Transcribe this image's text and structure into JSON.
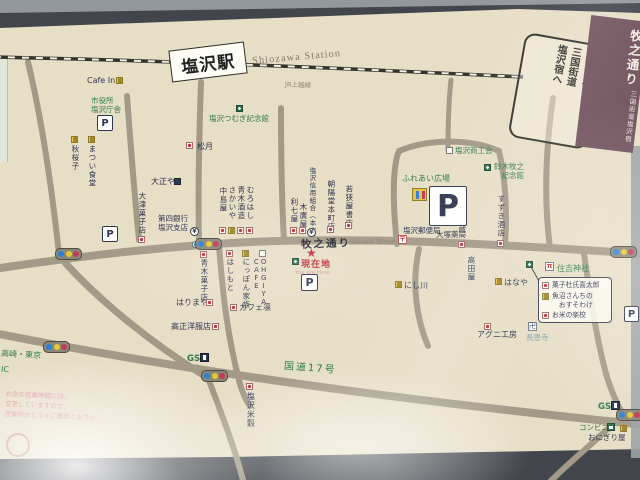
{
  "colors": {
    "board": "#e7dec6",
    "road": "#a29a87",
    "rail": "#33332f",
    "green": "#2e7b4e",
    "navy": "#2e3350",
    "red": "#c2303a",
    "banner": "#70515c",
    "wall": "#42464c",
    "signal_blue": "#2e7fd6",
    "signal_yellow": "#e6c92f",
    "signal_red": "#c23a55"
  },
  "station": {
    "name": "塩沢駅",
    "name_en": "Shiozawa Station",
    "line": "JR上越線"
  },
  "seal": {
    "text": "ようこそ、\n三国街道\n塩沢宿へ"
  },
  "banner": {
    "small": "三国街道塩沢宿",
    "large": "牧之通り"
  },
  "streets": {
    "bokushi": "牧之通り",
    "bokushi_en": "Bokushi Street",
    "route17": "国道17号"
  },
  "current_location": {
    "star": "★",
    "label": "現在地",
    "label_en": "You are Here"
  },
  "icon_glyphs": {
    "yen": "¥",
    "post": "〒",
    "torii": "π",
    "temple": "卍",
    "parking": "P"
  },
  "callout": {
    "items": [
      {
        "icon": "shop",
        "label": "菓子杜氏喜太郎"
      },
      {
        "icon": "food",
        "label": "魚沼さんちの\n　おすそわけ"
      },
      {
        "icon": "shop",
        "label": "お米の楽校"
      }
    ]
  },
  "note": {
    "text": "お店の営業時間には、\n変更していますので、\n営業中かどうかご確認ください"
  },
  "parkings": [
    {
      "x": 97,
      "y": 115,
      "w": 14,
      "h": 14,
      "fs": 10
    },
    {
      "x": 429,
      "y": 186,
      "w": 36,
      "h": 38,
      "fs": 30
    },
    {
      "x": 102,
      "y": 226,
      "w": 14,
      "h": 14,
      "fs": 10
    },
    {
      "x": 301,
      "y": 274,
      "w": 15,
      "h": 15,
      "fs": 11
    },
    {
      "x": 624,
      "y": 306,
      "w": 13,
      "h": 14,
      "fs": 10
    }
  ],
  "signals": [
    {
      "x": 55,
      "y": 248
    },
    {
      "x": 195,
      "y": 238
    },
    {
      "x": 610,
      "y": 246
    },
    {
      "x": 201,
      "y": 370
    },
    {
      "x": 43,
      "y": 341
    },
    {
      "x": 616,
      "y": 409
    }
  ],
  "pois": [
    {
      "id": "cafe-in",
      "label": "Cafe In",
      "x": 87,
      "y": 76,
      "s": 8,
      "roman": 1,
      "icon": "food",
      "ix": 116,
      "iy": 77
    },
    {
      "id": "city-office",
      "label": "市役所\n塩沢庁舎",
      "x": 91,
      "y": 96,
      "s": 7.5,
      "c": "green"
    },
    {
      "id": "matsui-shokudo",
      "label": "まつい食堂",
      "v": 1,
      "x": 88,
      "y": 145,
      "s": 7.5,
      "icon": "food",
      "ix": 88,
      "iy": 136
    },
    {
      "id": "shuoshi",
      "label": "秋桜子",
      "v": 1,
      "x": 71,
      "y": 145,
      "s": 7.5,
      "icon": "food",
      "ix": 71,
      "iy": 136
    },
    {
      "id": "tsumugi-kinenkan",
      "label": "塩沢つむぎ記念館",
      "x": 209,
      "y": 114,
      "s": 7.5,
      "c": "green",
      "icon": "pub",
      "ix": 236,
      "iy": 105
    },
    {
      "id": "shogetsu",
      "label": "松月",
      "x": 197,
      "y": 142,
      "s": 8,
      "icon": "shop",
      "ix": 186,
      "iy": 142
    },
    {
      "id": "taishoya",
      "label": "大正や",
      "x": 151,
      "y": 177,
      "s": 8,
      "icon": "dark",
      "ix": 174,
      "iy": 178
    },
    {
      "id": "otsu-kashiten",
      "label": "大津菓子店",
      "v": 1,
      "x": 138,
      "y": 192,
      "s": 7.5,
      "icon": "shop",
      "ix": 138,
      "iy": 236
    },
    {
      "id": "daishi-bank",
      "label": "第四銀行\n塩沢支店",
      "x": 158,
      "y": 214,
      "s": 7.5,
      "icon": "yen",
      "ix": 190,
      "iy": 227
    },
    {
      "id": "bank-dot",
      "label": "",
      "x": 0,
      "y": 0,
      "s": 1,
      "icon": "dotc",
      "ix": 192,
      "iy": 241
    },
    {
      "id": "nakajimaya",
      "label": "中島屋",
      "v": 1,
      "x": 219,
      "y": 187,
      "s": 7.5,
      "icon": "shop",
      "ix": 219,
      "iy": 227
    },
    {
      "id": "sakaiya",
      "label": "さかいや",
      "v": 1,
      "x": 228,
      "y": 186,
      "s": 7.5,
      "icon": "food",
      "ix": 228,
      "iy": 227
    },
    {
      "id": "aoki-shuzo",
      "label": "青木酒造",
      "v": 1,
      "x": 237,
      "y": 186,
      "s": 7.5,
      "icon": "shop",
      "ix": 237,
      "iy": 227
    },
    {
      "id": "murohashi",
      "label": "むろはし",
      "v": 1,
      "x": 246,
      "y": 186,
      "s": 7.5,
      "icon": "shop",
      "ix": 246,
      "iy": 227
    },
    {
      "id": "rishichiya",
      "label": "利七屋",
      "v": 1,
      "x": 290,
      "y": 198,
      "s": 7.5,
      "icon": "shop",
      "ix": 290,
      "iy": 227
    },
    {
      "id": "kihiroya",
      "label": "木廣屋",
      "v": 1,
      "x": 299,
      "y": 203,
      "s": 7.5,
      "icon": "shop",
      "ix": 299,
      "iy": 227
    },
    {
      "id": "shinkumi",
      "label": "塩沢信用組合（本店）",
      "v": 1,
      "x": 308,
      "y": 167,
      "s": 6.5,
      "icon": "yen",
      "ix": 307,
      "iy": 228
    },
    {
      "id": "choyodo",
      "label": "朝陽堂本町店",
      "v": 1,
      "x": 327,
      "y": 180,
      "s": 7.5,
      "icon": "shop",
      "ix": 327,
      "iy": 226
    },
    {
      "id": "wakasaya-shoten",
      "label": "若狭屋書店",
      "v": 1,
      "x": 345,
      "y": 185,
      "s": 7.5,
      "icon": "shop",
      "ix": 345,
      "iy": 222
    },
    {
      "id": "shokokai",
      "label": "塩沢商工会",
      "x": 455,
      "y": 146,
      "s": 7.5,
      "c": "green",
      "icon": "boxw",
      "ix": 446,
      "iy": 147
    },
    {
      "id": "suzuki-bokushi-kinenkan",
      "label": "鈴木牧之\n　記念館",
      "x": 494,
      "y": 162,
      "s": 7.5,
      "c": "green",
      "icon": "pub",
      "ix": 484,
      "iy": 164
    },
    {
      "id": "fureai-hiroba",
      "label": "ふれあい広場",
      "x": 402,
      "y": 174,
      "s": 8,
      "c": "green"
    },
    {
      "id": "post-office",
      "label": "塩沢郵便局",
      "x": 403,
      "y": 226,
      "s": 7.5,
      "icon": "post",
      "ix": 398,
      "iy": 235
    },
    {
      "id": "otsuka-yakkyoku",
      "label": "大塚薬局",
      "x": 436,
      "y": 230,
      "s": 7.5
    },
    {
      "id": "koshihikari-kura",
      "label": "越光食米蔵",
      "v": 1,
      "x": 458,
      "y": 191,
      "s": 7.5,
      "icon": "shop",
      "ix": 458,
      "iy": 241
    },
    {
      "id": "suzuki-saketen",
      "label": "すずき酒店",
      "v": 1,
      "x": 497,
      "y": 195,
      "s": 7.5,
      "icon": "shop",
      "ix": 497,
      "iy": 240
    },
    {
      "id": "takadaya",
      "label": "高田屋",
      "v": 1,
      "x": 467,
      "y": 256,
      "s": 7.5
    },
    {
      "id": "sumiyoshi-jinja",
      "label": "住吉神社",
      "x": 557,
      "y": 264,
      "s": 8,
      "c": "green",
      "icon": "torii",
      "ix": 545,
      "iy": 262
    },
    {
      "id": "nishikawa",
      "label": "にし川",
      "x": 404,
      "y": 281,
      "s": 8,
      "icon": "food",
      "ix": 395,
      "iy": 281
    },
    {
      "id": "hanaya",
      "label": "はなや",
      "x": 504,
      "y": 278,
      "s": 8,
      "icon": "food",
      "ix": 495,
      "iy": 278
    },
    {
      "id": "callout-marker",
      "label": "",
      "x": 0,
      "y": 0,
      "s": 1,
      "icon": "pub",
      "ix": 526,
      "iy": 261
    },
    {
      "id": "agni-kobo",
      "label": "アグニ工房",
      "x": 477,
      "y": 330,
      "s": 8,
      "icon": "shop",
      "ix": 484,
      "iy": 323
    },
    {
      "id": "choonji",
      "label": "長恩寺",
      "x": 526,
      "y": 333,
      "s": 7.5,
      "c": "pale",
      "icon": "temple",
      "ix": 528,
      "iy": 322
    },
    {
      "id": "aoki-kashiten",
      "label": "青木菓子店",
      "v": 1,
      "x": 200,
      "y": 259,
      "s": 7.5,
      "icon": "shop",
      "ix": 200,
      "iy": 251
    },
    {
      "id": "hashimoto",
      "label": "はしもと",
      "v": 1,
      "x": 226,
      "y": 258,
      "s": 7.5,
      "icon": "shop",
      "ix": 226,
      "iy": 250
    },
    {
      "id": "nippon-kazoku",
      "label": "にっぽん家族",
      "v": 1,
      "x": 242,
      "y": 258,
      "s": 7.5,
      "icon": "food",
      "ix": 242,
      "iy": 250
    },
    {
      "id": "ohgiya-cafe",
      "label": "OHGIYA\nCAFE",
      "v": 1,
      "x": 252,
      "y": 258,
      "s": 7,
      "roman": 1,
      "icon": "boxw",
      "ix": 259,
      "iy": 250
    },
    {
      "id": "cafe-rin",
      "label": "カフェ凛",
      "x": 239,
      "y": 303,
      "s": 8,
      "icon": "shop",
      "ix": 230,
      "iy": 304
    },
    {
      "id": "harimaya",
      "label": "はりまや",
      "x": 176,
      "y": 298,
      "s": 8,
      "icon": "shop",
      "ix": 206,
      "iy": 299
    },
    {
      "id": "takasho-yofukuten",
      "label": "高正洋服店",
      "x": 171,
      "y": 322,
      "s": 8,
      "icon": "shop",
      "ix": 212,
      "iy": 323
    },
    {
      "id": "gs-west",
      "label": "GS",
      "x": 187,
      "y": 354,
      "s": 8.5,
      "c": "green",
      "b": 1,
      "icon": "gas",
      "ix": 200,
      "iy": 353
    },
    {
      "id": "shiozawa-beikoku",
      "label": "塩沢米穀",
      "v": 1,
      "x": 246,
      "y": 392,
      "s": 8,
      "icon": "shop",
      "ix": 246,
      "iy": 383
    },
    {
      "id": "gs-east",
      "label": "GS",
      "x": 598,
      "y": 402,
      "s": 8.5,
      "c": "green",
      "b": 1,
      "icon": "gas",
      "ix": 611,
      "iy": 401
    },
    {
      "id": "conbini",
      "label": "コンビニ",
      "x": 579,
      "y": 423,
      "s": 7.5,
      "c": "green",
      "icon": "conv",
      "ix": 607,
      "iy": 423
    },
    {
      "id": "onigiriya",
      "label": "おにぎり屋",
      "x": 588,
      "y": 433,
      "s": 7.5,
      "icon": "food",
      "ix": 620,
      "iy": 425
    },
    {
      "id": "dir-takasaki-tokyo",
      "label": "高崎・東京",
      "x": 1,
      "y": 350,
      "s": 8,
      "c": "green",
      "rot": 3
    },
    {
      "id": "dir-ic",
      "label": "IC",
      "x": 1,
      "y": 365,
      "s": 8,
      "c": "green",
      "rot": 3
    }
  ]
}
